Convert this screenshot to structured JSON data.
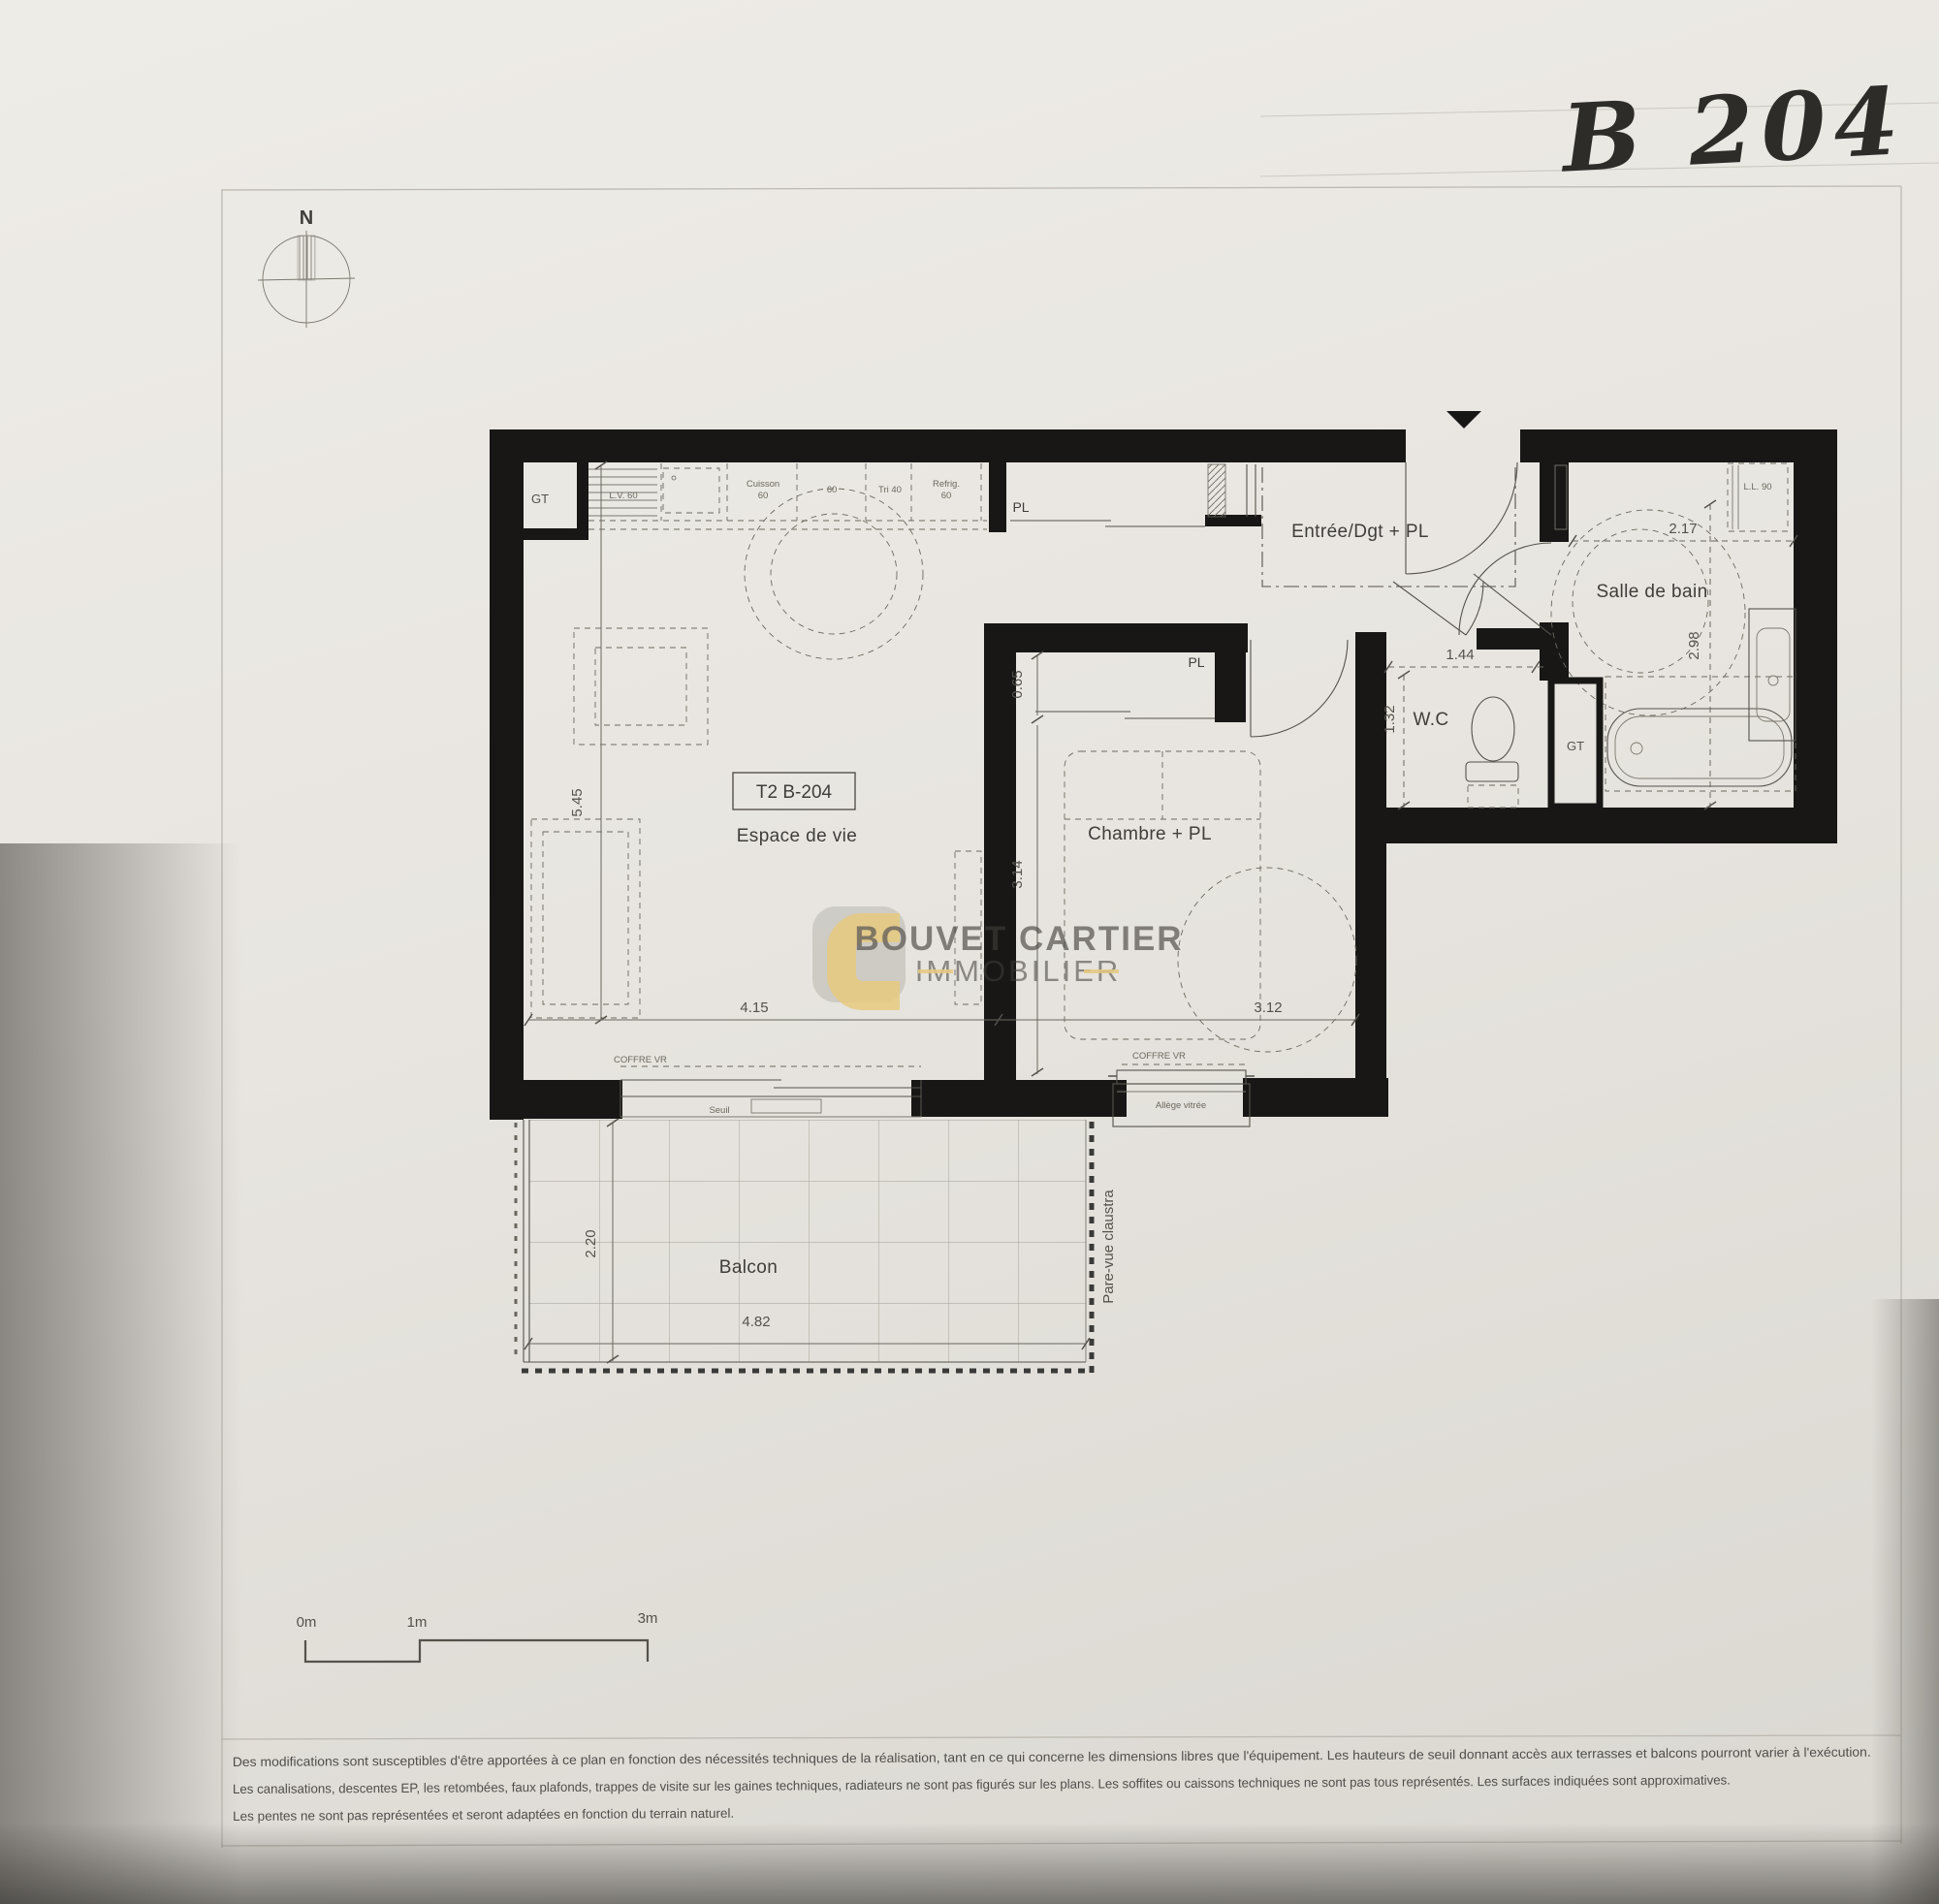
{
  "photo": {
    "handwritten_label": "B 204"
  },
  "compass": {
    "north": "N"
  },
  "logo": {
    "line1": "BOUVET CARTIER",
    "line2": "IMMOBILIER",
    "yellow": "#e7c46a",
    "gray": "#8e8a84"
  },
  "plan": {
    "unit_tag": "T2 B-204",
    "rooms": {
      "living": "Espace de vie",
      "bedroom": "Chambre + PL",
      "entry": "Entrée/Dgt + PL",
      "bathroom": "Salle de bain",
      "wc": "W.C",
      "balcony": "Balcon"
    },
    "labels": {
      "gt": "GT",
      "pl": "PL",
      "lv": "L.V. 60",
      "cuisson_1": "Cuisson",
      "cuisson_2": "60",
      "sixty": "60",
      "tri": "Tri 40",
      "refrig_1": "Refrig.",
      "refrig_2": "60",
      "ll": "L.L. 90",
      "coffre_vr": "COFFRE VR",
      "seuil": "Seuil",
      "allege": "Allège vitrée",
      "pare_vue": "Pare-vue claustra"
    },
    "dims": {
      "living_depth": "5.45",
      "living_width": "4.15",
      "bedroom_width": "3.12",
      "bedroom_depth": "3.14",
      "bedroom_pl_depth": "0.65",
      "balcony_depth": "2.20",
      "balcony_width": "4.82",
      "wc_width": "1.44",
      "wc_depth": "1.32",
      "bath_width": "2.17",
      "bath_depth": "2.98"
    }
  },
  "scalebar": {
    "m0": "0m",
    "m1": "1m",
    "m3": "3m"
  },
  "disclaimer": {
    "line1": "Des modifications sont susceptibles d'être apportées à ce plan en fonction des nécessités techniques de la réalisation, tant en ce qui concerne les dimensions libres que l'équipement. Les hauteurs de seuil donnant accès aux terrasses et balcons pourront varier à l'exécution.",
    "line2": "Les canalisations, descentes EP, les retombées, faux plafonds, trappes de visite sur les gaines techniques, radiateurs ne sont pas figurés sur les plans. Les soffites ou caissons techniques ne sont pas tous représentés. Les surfaces indiquées sont approximatives.",
    "line3": "Les pentes ne sont pas représentées et seront adaptées en fonction du terrain naturel."
  }
}
